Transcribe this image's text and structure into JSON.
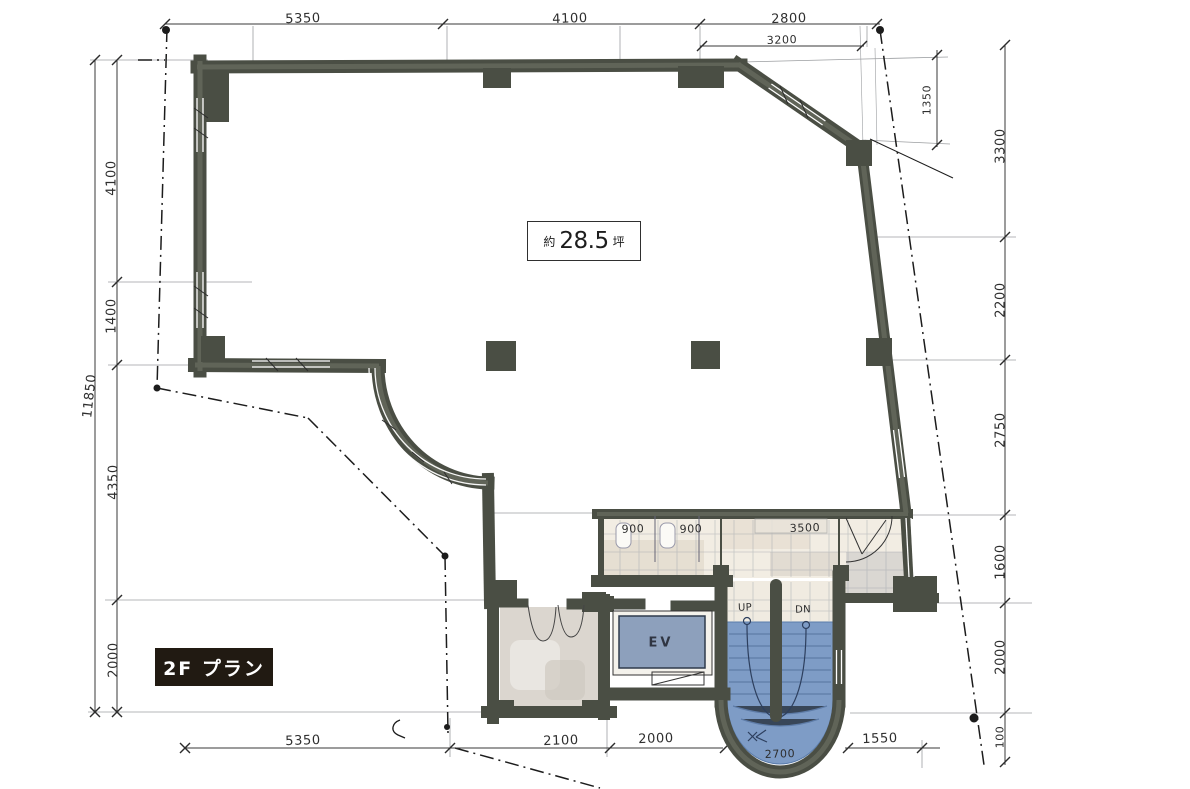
{
  "floor_label": "2F プラン",
  "area": {
    "prefix": "約",
    "value": "28.5",
    "unit": "坪"
  },
  "annotations": {
    "up": "UP",
    "down": "DN",
    "elevator": "EV"
  },
  "dimensions": {
    "top": [
      "5350",
      "4100",
      "2800"
    ],
    "top_offset": "3200",
    "top_right_drop": "1350",
    "left": [
      "4100",
      "1400",
      "4350",
      "2000"
    ],
    "left_overall": "11850",
    "right": [
      "3300",
      "2200",
      "2750",
      "1600",
      "2000",
      "100"
    ],
    "bottom": [
      "5350",
      "2100",
      "2000",
      "1550"
    ],
    "stair_width": "2700",
    "washroom": [
      "900",
      "900",
      "3500"
    ]
  },
  "colors": {
    "wall": "#4a4e44",
    "wall_highlight": "#72766a",
    "stair_fill": "#7e9cc6",
    "elevator_fill": "#8da0bc",
    "tile": "#f2ede3",
    "ink": "#2e2e2e",
    "tag_background": "#211a12",
    "tag_text": "#ffffff"
  }
}
